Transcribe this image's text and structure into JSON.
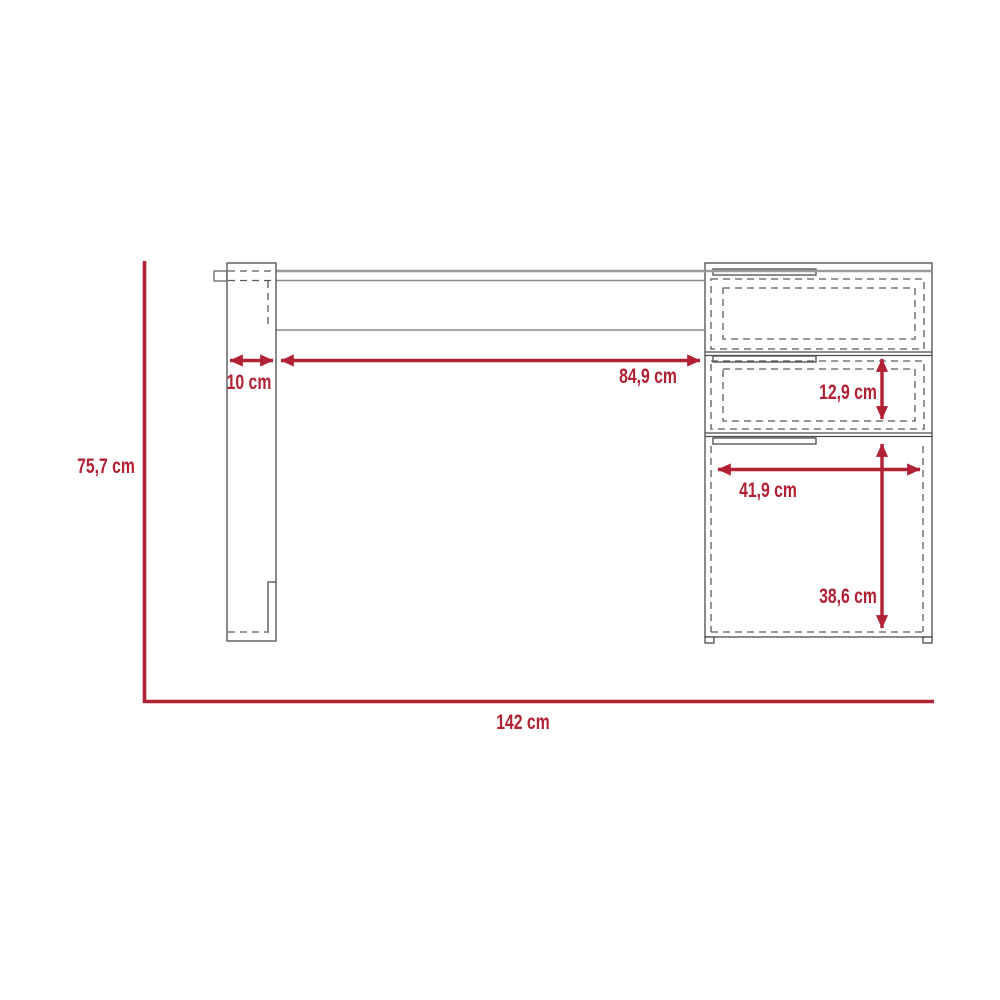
{
  "diagram": {
    "type": "furniture-dimension-drawing",
    "subject": "desk with left leg panel and right drawer unit (front view)",
    "labels": {
      "overall_height": "75,7 cm",
      "overall_width": "142 cm",
      "leg_width": "10 cm",
      "knee_space_width": "84,9 cm",
      "drawer_height": "12,9 cm",
      "drawer_width": "41,9 cm",
      "cabinet_height": "38,6 cm"
    },
    "colors": {
      "dimension_red": "#B12033",
      "outline_gray": "#4a4a4a",
      "hidden_line_gray": "#5a5a5a",
      "surface_edge_gray": "#9b9b9b",
      "background": "#ffffff"
    }
  }
}
